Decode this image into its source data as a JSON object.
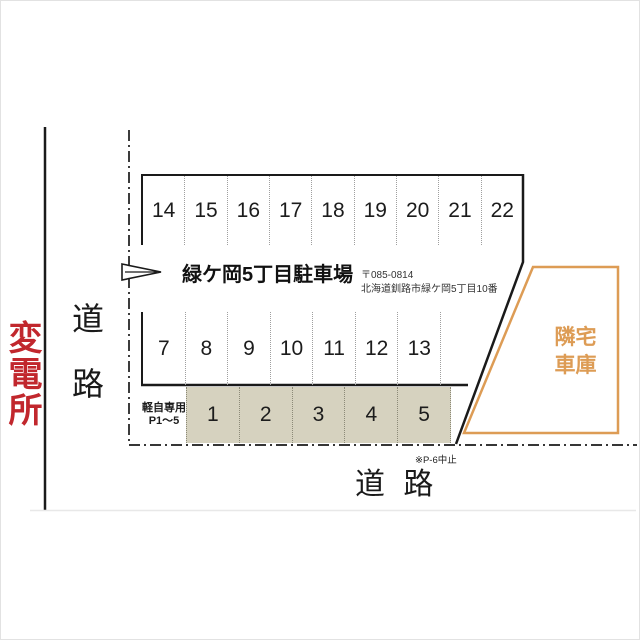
{
  "colors": {
    "substation_red": "#c1272d",
    "garage_orange": "#dd9c55",
    "light_car_beige": "#d6d2bf"
  },
  "surroundings": {
    "substation_label": "変電所",
    "road_left_label": "道路",
    "road_bottom_label": "道 路"
  },
  "lot": {
    "title": "緑ケ岡5丁目駐車場",
    "postal_code": "〒085-0814",
    "address": "北海道釧路市緑ケ岡5丁目10番",
    "top_row_spaces": [
      "14",
      "15",
      "16",
      "17",
      "18",
      "19",
      "20",
      "21",
      "22"
    ],
    "middle_row_spaces": [
      "7",
      "8",
      "9",
      "10",
      "11",
      "12",
      "13"
    ],
    "light_car_spaces": [
      "1",
      "2",
      "3",
      "4",
      "5"
    ],
    "light_car_label_line1": "軽自専用",
    "light_car_label_line2": "P1〜5",
    "note": "※P-6中止"
  },
  "neighbor_garage": {
    "label_line1": "隣宅",
    "label_line2": "車庫"
  }
}
